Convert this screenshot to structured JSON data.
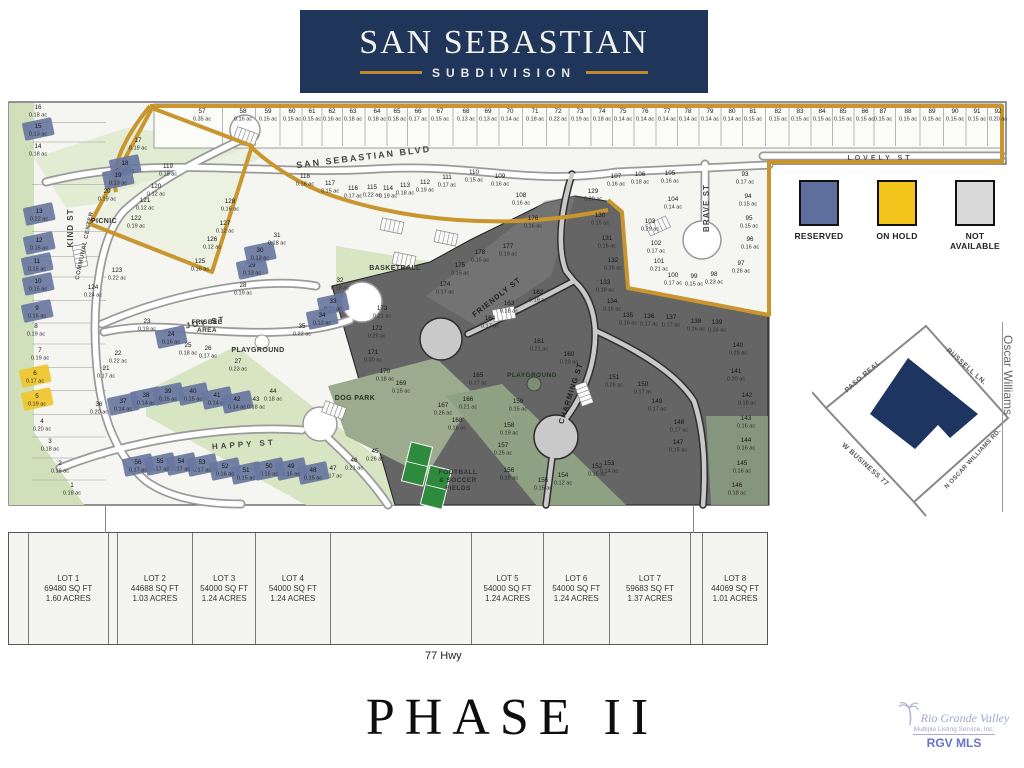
{
  "header": {
    "title": "SAN SEBASTIAN",
    "subtitle": "SUBDIVISION"
  },
  "colors": {
    "navy": "#20355a",
    "gold_rule": "#c0872e",
    "boundary_gold": "#c9952f",
    "reserved": "#68779f",
    "on_hold": "#f0c52b",
    "not_available": "#d9d9d9",
    "dark_region": "#656565",
    "park_green": "#d7e5c3",
    "sage": "#92a285",
    "street": "#ffffff"
  },
  "legend": {
    "items": [
      {
        "label": "RESERVED",
        "color": "#5f6f9d"
      },
      {
        "label": "ON HOLD",
        "color": "#f3c41c"
      },
      {
        "label": "NOT AVAILABLE",
        "color": "#d9d9d9"
      }
    ]
  },
  "map": {
    "streets": [
      {
        "t": "SAN SEBASTIAN BLVD",
        "x": 358,
        "y": 64,
        "r": -7,
        "s": 9,
        "ls": 2,
        "c": "#444"
      },
      {
        "t": "LOVELY ST",
        "x": 874,
        "y": 64,
        "r": 0,
        "s": 7,
        "ls": 3,
        "c": "#555"
      },
      {
        "t": "KIND ST",
        "x": 67,
        "y": 132,
        "r": -90,
        "s": 8,
        "ls": 1,
        "c": "#444"
      },
      {
        "t": "COMMUNAL CENTER",
        "x": 80,
        "y": 150,
        "r": -78,
        "s": 6,
        "ls": 0.5,
        "c": "#555"
      },
      {
        "t": "JOY ST",
        "x": 200,
        "y": 229,
        "r": -10,
        "s": 8,
        "ls": 2,
        "c": "#444"
      },
      {
        "t": "HAPPY ST",
        "x": 238,
        "y": 351,
        "r": -4,
        "s": 8,
        "ls": 3,
        "c": "#444"
      },
      {
        "t": "FRIENDLY ST",
        "x": 492,
        "y": 203,
        "r": -38,
        "s": 7.5,
        "ls": 1,
        "c": "#222"
      },
      {
        "t": "CHARMING ST",
        "x": 567,
        "y": 298,
        "r": -72,
        "s": 7.5,
        "ls": 1,
        "c": "#222"
      },
      {
        "t": "BRAVE ST",
        "x": 703,
        "y": 112,
        "r": -90,
        "s": 8,
        "ls": 1,
        "c": "#444"
      }
    ],
    "amenities": [
      {
        "lines": [
          "PICNIC"
        ],
        "x": 98,
        "y": 127,
        "s": 7,
        "c": "#333"
      },
      {
        "lines": [
          "FRISBEE",
          "AREA"
        ],
        "x": 201,
        "y": 228,
        "s": 6.5,
        "c": "#333"
      },
      {
        "lines": [
          "PLAYGROUND"
        ],
        "x": 252,
        "y": 256,
        "s": 7,
        "c": "#333"
      },
      {
        "lines": [
          "BASKETBALL"
        ],
        "x": 389,
        "y": 174,
        "s": 7,
        "c": "#333"
      },
      {
        "lines": [
          "PLAYGROUND"
        ],
        "x": 526,
        "y": 281,
        "s": 6.5,
        "c": "#1e3b1e"
      },
      {
        "lines": [
          "DOG PARK"
        ],
        "x": 349,
        "y": 304,
        "s": 7,
        "c": "#253425"
      },
      {
        "lines": [
          "FOOTBALL",
          "& SOCCER",
          "FIELDS"
        ],
        "x": 452,
        "y": 378,
        "s": 6.5,
        "c": "#333"
      }
    ],
    "lots": [
      [
        57,
        "0.35",
        196,
        17,
        0,
        "t"
      ],
      [
        58,
        "0.16",
        237,
        17,
        0,
        "t"
      ],
      [
        59,
        "0.15",
        262,
        17,
        0,
        "t"
      ],
      [
        60,
        "0.15",
        286,
        17,
        0,
        "t"
      ],
      [
        61,
        "0.15",
        306,
        17,
        0,
        "t"
      ],
      [
        62,
        "0.16",
        326,
        17,
        0,
        "t"
      ],
      [
        63,
        "0.18",
        347,
        17,
        0,
        "t"
      ],
      [
        64,
        "0.18",
        371,
        17,
        0,
        "t"
      ],
      [
        65,
        "0.18",
        391,
        17,
        0,
        "t"
      ],
      [
        66,
        "0.17",
        412,
        17,
        0,
        "t"
      ],
      [
        67,
        "0.15",
        434,
        17,
        0,
        "t"
      ],
      [
        68,
        "0.13",
        460,
        17,
        0,
        "t"
      ],
      [
        69,
        "0.13",
        482,
        17,
        0,
        "t"
      ],
      [
        70,
        "0.14",
        504,
        17,
        0,
        "t"
      ],
      [
        71,
        "0.18",
        529,
        17,
        0,
        "t"
      ],
      [
        72,
        "0.22",
        552,
        17,
        0,
        "t"
      ],
      [
        73,
        "0.19",
        574,
        17,
        0,
        "t"
      ],
      [
        74,
        "0.18",
        596,
        17,
        0,
        "t"
      ],
      [
        75,
        "0.14",
        617,
        17,
        0,
        "t"
      ],
      [
        76,
        "0.14",
        639,
        17,
        0,
        "t"
      ],
      [
        77,
        "0.14",
        661,
        17,
        0,
        "t"
      ],
      [
        78,
        "0.14",
        682,
        17,
        0,
        "t"
      ],
      [
        79,
        "0.14",
        704,
        17,
        0,
        "t"
      ],
      [
        80,
        "0.14",
        726,
        17,
        0,
        "t"
      ],
      [
        81,
        "0.15",
        747,
        17,
        0,
        "t"
      ],
      [
        82,
        "0.15",
        772,
        17,
        0,
        "t"
      ],
      [
        83,
        "0.15",
        794,
        17,
        0,
        "t"
      ],
      [
        84,
        "0.15",
        816,
        17,
        0,
        "t"
      ],
      [
        85,
        "0.15",
        837,
        17,
        0,
        "t"
      ],
      [
        86,
        "0.15",
        859,
        17,
        0,
        "t"
      ],
      [
        87,
        "0.15",
        877,
        17,
        0,
        "t"
      ],
      [
        88,
        "0.15",
        902,
        17,
        0,
        "t"
      ],
      [
        89,
        "0.15",
        926,
        17,
        0,
        "t"
      ],
      [
        90,
        "0.15",
        949,
        17,
        0,
        "t"
      ],
      [
        91,
        "0.15",
        971,
        17,
        0,
        "t"
      ],
      [
        92,
        "0.20",
        992,
        17,
        0,
        "t"
      ],
      [
        16,
        "0.18",
        32,
        13,
        0,
        "l"
      ],
      [
        15,
        "0.13",
        32,
        32,
        1,
        "l"
      ],
      [
        14,
        "0.18",
        32,
        52,
        0,
        "l"
      ],
      [
        13,
        "0.22",
        33,
        117,
        1,
        "l"
      ],
      [
        12,
        "0.15",
        33,
        146,
        1,
        "l"
      ],
      [
        11,
        "0.15",
        31,
        167,
        1,
        "l"
      ],
      [
        10,
        "0.15",
        32,
        187,
        1,
        "l"
      ],
      [
        9,
        "0.16",
        31,
        214,
        1,
        "l"
      ],
      [
        8,
        "0.19",
        30,
        232,
        0,
        "l"
      ],
      [
        7,
        "0.19",
        34,
        256,
        0,
        "l"
      ],
      [
        6,
        "0.17",
        29,
        279,
        2,
        "l"
      ],
      [
        5,
        "0.19",
        31,
        302,
        2,
        "l"
      ],
      [
        4,
        "0.20",
        36,
        327,
        0,
        "l"
      ],
      [
        3,
        "0.18",
        44,
        347,
        0,
        "l"
      ],
      [
        2,
        "0.18",
        54,
        369,
        0,
        "l"
      ],
      [
        1,
        "0.18",
        66,
        391,
        0,
        "l"
      ],
      [
        17,
        "0.19",
        132,
        46,
        0
      ],
      [
        18,
        "0.13",
        119,
        69,
        1
      ],
      [
        19,
        "0.13",
        112,
        81,
        1
      ],
      [
        20,
        "0.19",
        101,
        97,
        0
      ],
      [
        119,
        "0.18",
        162,
        72,
        0
      ],
      [
        120,
        "0.12",
        150,
        92,
        0
      ],
      [
        121,
        "0.12",
        139,
        106,
        0
      ],
      [
        122,
        "0.19",
        130,
        124,
        0
      ],
      [
        123,
        "0.22",
        111,
        176,
        0
      ],
      [
        124,
        "0.24",
        87,
        193,
        0
      ],
      [
        21,
        "0.17",
        100,
        274,
        0
      ],
      [
        22,
        "0.22",
        112,
        259,
        0
      ],
      [
        23,
        "0.19",
        141,
        227,
        0
      ],
      [
        24,
        "0.16",
        165,
        240,
        1
      ],
      [
        25,
        "0.18",
        182,
        251,
        0
      ],
      [
        26,
        "0.17",
        202,
        254,
        0
      ],
      [
        27,
        "0.23",
        232,
        267,
        0
      ],
      [
        28,
        "0.19",
        237,
        191,
        0
      ],
      [
        29,
        "0.13",
        246,
        171,
        1
      ],
      [
        30,
        "0.12",
        254,
        156,
        1
      ],
      [
        31,
        "0.18",
        271,
        141,
        0
      ],
      [
        32,
        "0.18",
        334,
        186,
        0
      ],
      [
        33,
        "0.11",
        327,
        207,
        1
      ],
      [
        34,
        "0.12",
        316,
        221,
        1
      ],
      [
        35,
        "0.22",
        296,
        232,
        0
      ],
      [
        36,
        "0.20",
        93,
        310,
        0
      ],
      [
        37,
        "0.14",
        117,
        307,
        1
      ],
      [
        38,
        "0.14",
        140,
        301,
        1
      ],
      [
        39,
        "0.15",
        162,
        297,
        1
      ],
      [
        40,
        "0.15",
        187,
        297,
        1
      ],
      [
        41,
        "0.14",
        211,
        301,
        1
      ],
      [
        42,
        "0.14",
        231,
        305,
        1
      ],
      [
        43,
        "0.18",
        250,
        305,
        0
      ],
      [
        44,
        "0.18",
        267,
        297,
        0
      ],
      [
        45,
        "0.26",
        369,
        357,
        0
      ],
      [
        46,
        "0.21",
        348,
        366,
        0
      ],
      [
        47,
        "0.17",
        327,
        374,
        0
      ],
      [
        48,
        "0.15",
        307,
        376,
        1
      ],
      [
        49,
        "0.15",
        285,
        372,
        1
      ],
      [
        50,
        "0.15",
        263,
        372,
        1
      ],
      [
        51,
        "0.15",
        240,
        376,
        1
      ],
      [
        52,
        "0.16",
        219,
        372,
        1
      ],
      [
        53,
        "0.17",
        196,
        368,
        1
      ],
      [
        54,
        "0.17",
        175,
        367,
        1
      ],
      [
        55,
        "0.17",
        154,
        367,
        1
      ],
      [
        56,
        "0.17",
        132,
        368,
        1
      ],
      [
        108,
        "0.16",
        515,
        101,
        0
      ],
      [
        109,
        "0.16",
        494,
        82,
        0
      ],
      [
        110,
        "0.15",
        468,
        78,
        0
      ],
      [
        111,
        "0.17",
        441,
        83,
        0
      ],
      [
        112,
        "0.19",
        419,
        88,
        0
      ],
      [
        113,
        "0.18",
        399,
        91,
        0
      ],
      [
        114,
        "0.19",
        382,
        94,
        0
      ],
      [
        115,
        "0.22",
        366,
        93,
        0
      ],
      [
        116,
        "0.17",
        347,
        94,
        0
      ],
      [
        117,
        "0.15",
        324,
        89,
        0
      ],
      [
        118,
        "0.16",
        299,
        82,
        0
      ],
      [
        93,
        "0.17",
        739,
        80,
        0
      ],
      [
        94,
        "0.15",
        742,
        102,
        0
      ],
      [
        95,
        "0.15",
        743,
        124,
        0
      ],
      [
        96,
        "0.16",
        744,
        145,
        0
      ],
      [
        97,
        "0.26",
        735,
        169,
        0
      ],
      [
        98,
        "0.23",
        708,
        180,
        0
      ],
      [
        99,
        "0.15",
        688,
        182,
        0
      ],
      [
        100,
        "0.17",
        667,
        181,
        0
      ],
      [
        101,
        "0.21",
        653,
        167,
        0
      ],
      [
        102,
        "0.17",
        650,
        149,
        0
      ],
      [
        103,
        "0.29",
        644,
        127,
        0
      ],
      [
        104,
        "0.14",
        667,
        105,
        0
      ],
      [
        105,
        "0.16",
        664,
        79,
        0
      ],
      [
        106,
        "0.18",
        634,
        80,
        0
      ],
      [
        107,
        "0.16",
        610,
        82,
        0
      ],
      [
        125,
        "0.16",
        194,
        167,
        0
      ],
      [
        126,
        "0.12",
        206,
        145,
        0
      ],
      [
        127,
        "0.12",
        219,
        129,
        0
      ],
      [
        128,
        "0.16",
        224,
        107,
        0
      ],
      [
        129,
        "0.20",
        587,
        97,
        3
      ],
      [
        130,
        "0.15",
        594,
        121,
        3
      ],
      [
        131,
        "0.16",
        601,
        144,
        3
      ],
      [
        132,
        "0.16",
        607,
        166,
        3
      ],
      [
        133,
        "0.19",
        599,
        188,
        3
      ],
      [
        134,
        "0.15",
        606,
        207,
        3
      ],
      [
        135,
        "0.16",
        622,
        221,
        3
      ],
      [
        136,
        "0.17",
        643,
        222,
        3
      ],
      [
        137,
        "0.17",
        665,
        223,
        3
      ],
      [
        138,
        "0.16",
        690,
        227,
        3
      ],
      [
        139,
        "0.24",
        711,
        228,
        3
      ],
      [
        140,
        "0.29",
        732,
        251,
        3
      ],
      [
        141,
        "0.20",
        730,
        277,
        3
      ],
      [
        142,
        "0.18",
        741,
        301,
        3
      ],
      [
        143,
        "0.16",
        740,
        324,
        3
      ],
      [
        144,
        "0.16",
        740,
        346,
        3
      ],
      [
        145,
        "0.16",
        736,
        369,
        3
      ],
      [
        146,
        "0.18",
        731,
        391,
        3
      ],
      [
        147,
        "0.15",
        672,
        348,
        3
      ],
      [
        148,
        "0.17",
        673,
        328,
        3
      ],
      [
        149,
        "0.17",
        651,
        307,
        3
      ],
      [
        150,
        "0.17",
        637,
        290,
        3
      ],
      [
        151,
        "0.26",
        608,
        283,
        3
      ],
      [
        152,
        "0.15",
        591,
        372,
        3
      ],
      [
        153,
        "0.14",
        603,
        369,
        3
      ],
      [
        154,
        "0.12",
        557,
        381,
        3
      ],
      [
        155,
        "0.15",
        537,
        386,
        3
      ],
      [
        156,
        "0.19",
        503,
        376,
        3
      ],
      [
        157,
        "0.26",
        497,
        351,
        3
      ],
      [
        158,
        "0.19",
        503,
        331,
        3
      ],
      [
        159,
        "0.15",
        512,
        307,
        3
      ],
      [
        160,
        "0.20",
        563,
        260,
        3
      ],
      [
        161,
        "0.21",
        533,
        247,
        3
      ],
      [
        162,
        "0.19",
        532,
        198,
        3
      ],
      [
        163,
        "0.18",
        503,
        209,
        3
      ],
      [
        164,
        "0.17",
        484,
        224,
        3
      ],
      [
        165,
        "0.17",
        472,
        281,
        3
      ],
      [
        166,
        "0.21",
        462,
        305,
        3
      ],
      [
        167,
        "0.26",
        437,
        311,
        3
      ],
      [
        168,
        "0.16",
        451,
        326,
        3
      ],
      [
        169,
        "0.15",
        395,
        289,
        3
      ],
      [
        170,
        "0.18",
        379,
        277,
        3
      ],
      [
        171,
        "0.30",
        367,
        258,
        3
      ],
      [
        172,
        "0.25",
        371,
        234,
        3
      ],
      [
        173,
        "0.21",
        376,
        214,
        3
      ],
      [
        174,
        "0.17",
        439,
        190,
        3
      ],
      [
        175,
        "0.15",
        454,
        171,
        3
      ],
      [
        176,
        "0.16",
        527,
        124,
        3
      ],
      [
        177,
        "0.19",
        502,
        152,
        3
      ],
      [
        178,
        "0.15",
        474,
        158,
        3
      ]
    ]
  },
  "inset": {
    "roads": [
      "PASO REAL",
      "RUSSELL LN.",
      "N OSCAR WILLIAMS RD.",
      "W BUSINESS 77"
    ],
    "right_road": "Oscar Williams"
  },
  "bottom": {
    "highway": "77 Hwy",
    "columns": [
      {
        "w": 20
      },
      {
        "w": 80,
        "lot": "LOT 1",
        "sqft": "69480 SQ FT",
        "acres": "1.60 ACRES"
      },
      {
        "w": 9
      },
      {
        "w": 76,
        "lot": "LOT 2",
        "sqft": "44688 SQ FT",
        "acres": "1.03 ACRES"
      },
      {
        "w": 63,
        "lot": "LOT 3",
        "sqft": "54000 SQ FT",
        "acres": "1.24 ACRES"
      },
      {
        "w": 75,
        "lot": "LOT 4",
        "sqft": "54000 SQ FT",
        "acres": "1.24 ACRES"
      },
      {
        "w": 142
      },
      {
        "w": 72,
        "lot": "LOT 5",
        "sqft": "54000 SQ FT",
        "acres": "1.24 ACRES"
      },
      {
        "w": 66,
        "lot": "LOT 6",
        "sqft": "54000 SQ FT",
        "acres": "1.24 ACRES"
      },
      {
        "w": 82,
        "lot": "LOT 7",
        "sqft": "59683 SQ FT",
        "acres": "1.37 ACRES"
      },
      {
        "w": 12
      },
      {
        "w": 64,
        "lot": "LOT 8",
        "sqft": "44069 SQ FT",
        "acres": "1.01 ACRES"
      }
    ]
  },
  "phase": "PHASE II",
  "watermark": {
    "line1": "Rio Grande Valley",
    "line2": "Multiple Listing Service, Inc.",
    "line3": "RGV MLS"
  }
}
